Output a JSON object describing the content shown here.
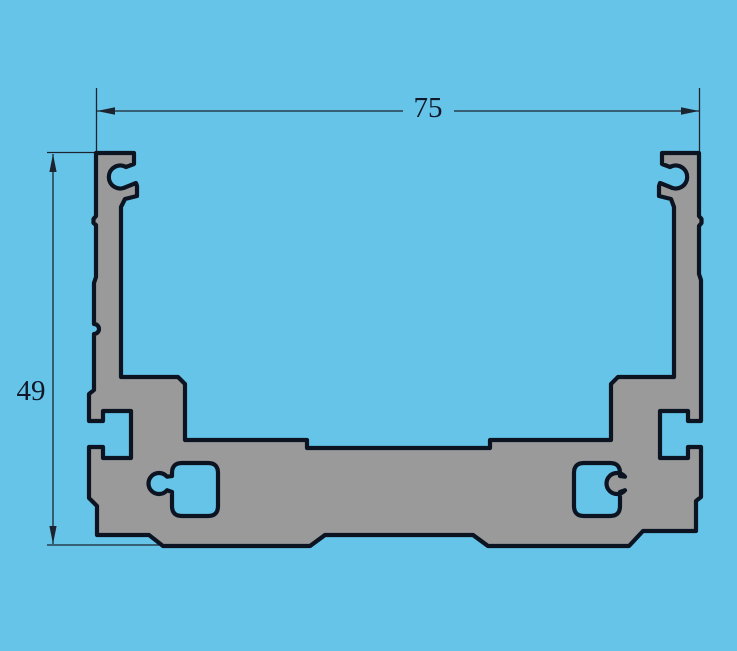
{
  "drawing": {
    "title": "extrusion-profile-cross-section",
    "part": "aluminum-extrusion-u-channel",
    "dimensions": {
      "width_label": "75",
      "height_label": "49"
    },
    "features": {
      "screw_channels": 2,
      "side_t_slots": 2,
      "base_keyhole_openings": 2
    },
    "colors": {
      "background": "#66C4E8",
      "profile_fill": "#9A9A9B",
      "profile_outline": "#0C1422",
      "dimension_line": "#1C2430",
      "text": "#10182A"
    }
  }
}
